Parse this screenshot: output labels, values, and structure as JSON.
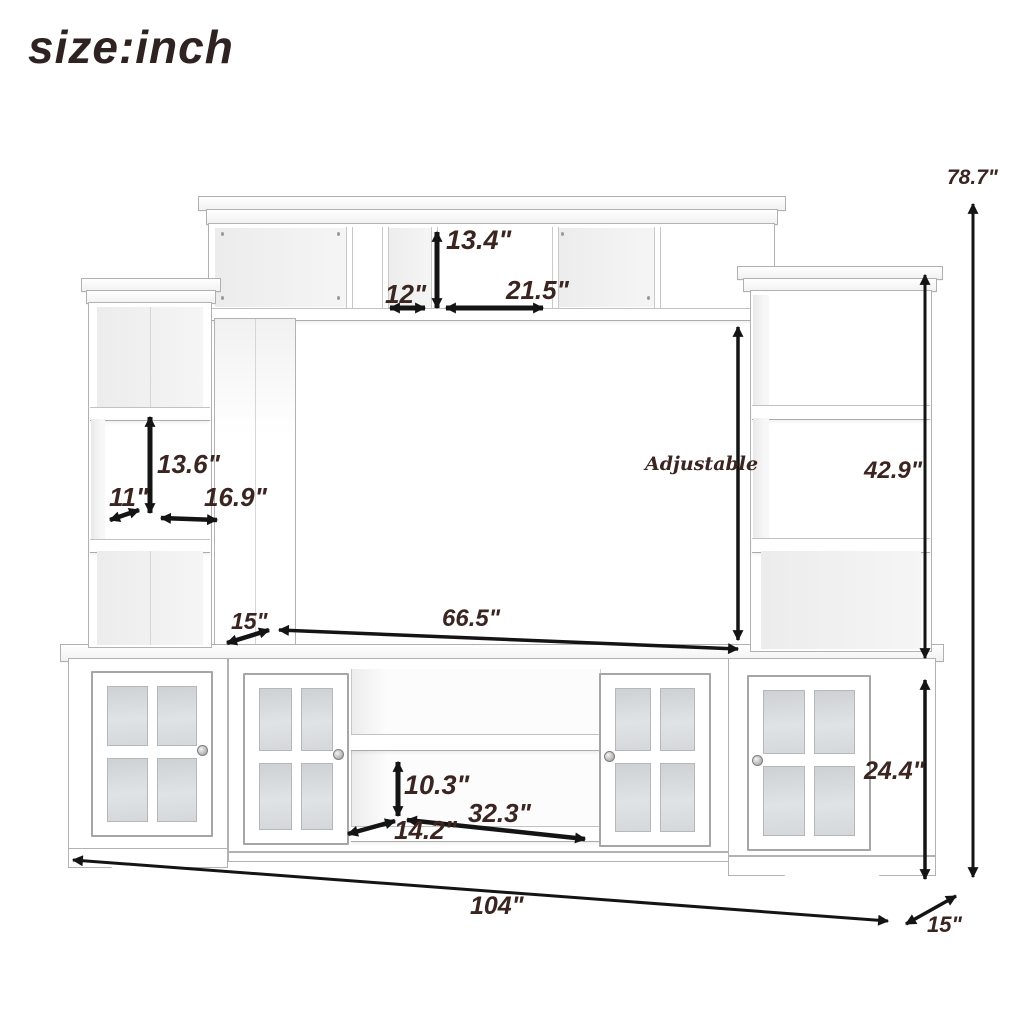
{
  "title": "size:inch",
  "diagram": {
    "type": "furniture-dimension-diagram",
    "product": "entertainment center wall unit with bridge, side towers and glass-door console",
    "dimensions": {
      "overall_width": "104\"",
      "overall_height": "78.7\"",
      "overall_depth": "15\"",
      "bridge_opening_height": "13.4\"",
      "bridge_left_compartment_width": "12\"",
      "bridge_right_compartment_width": "21.5\"",
      "tower_opening_height": "42.9\"",
      "tower_shelf_spacing": "13.6\"",
      "tower_depth": "11\"",
      "tower_width": "16.9\"",
      "tower_shelf_note": "Adjustable",
      "pier_top_depth": "15\"",
      "tv_opening_width": "66.5\"",
      "console_shelf_clearance": "10.3\"",
      "console_depth": "14.2\"",
      "console_open_compartment_width": "32.3\"",
      "console_height": "24.4\""
    },
    "colors": {
      "background": "#ffffff",
      "line_art": "#b2b2b2",
      "arrow": "#141414",
      "dimension_text": "#3a2520",
      "glass_pane": "#d3d7da"
    }
  }
}
